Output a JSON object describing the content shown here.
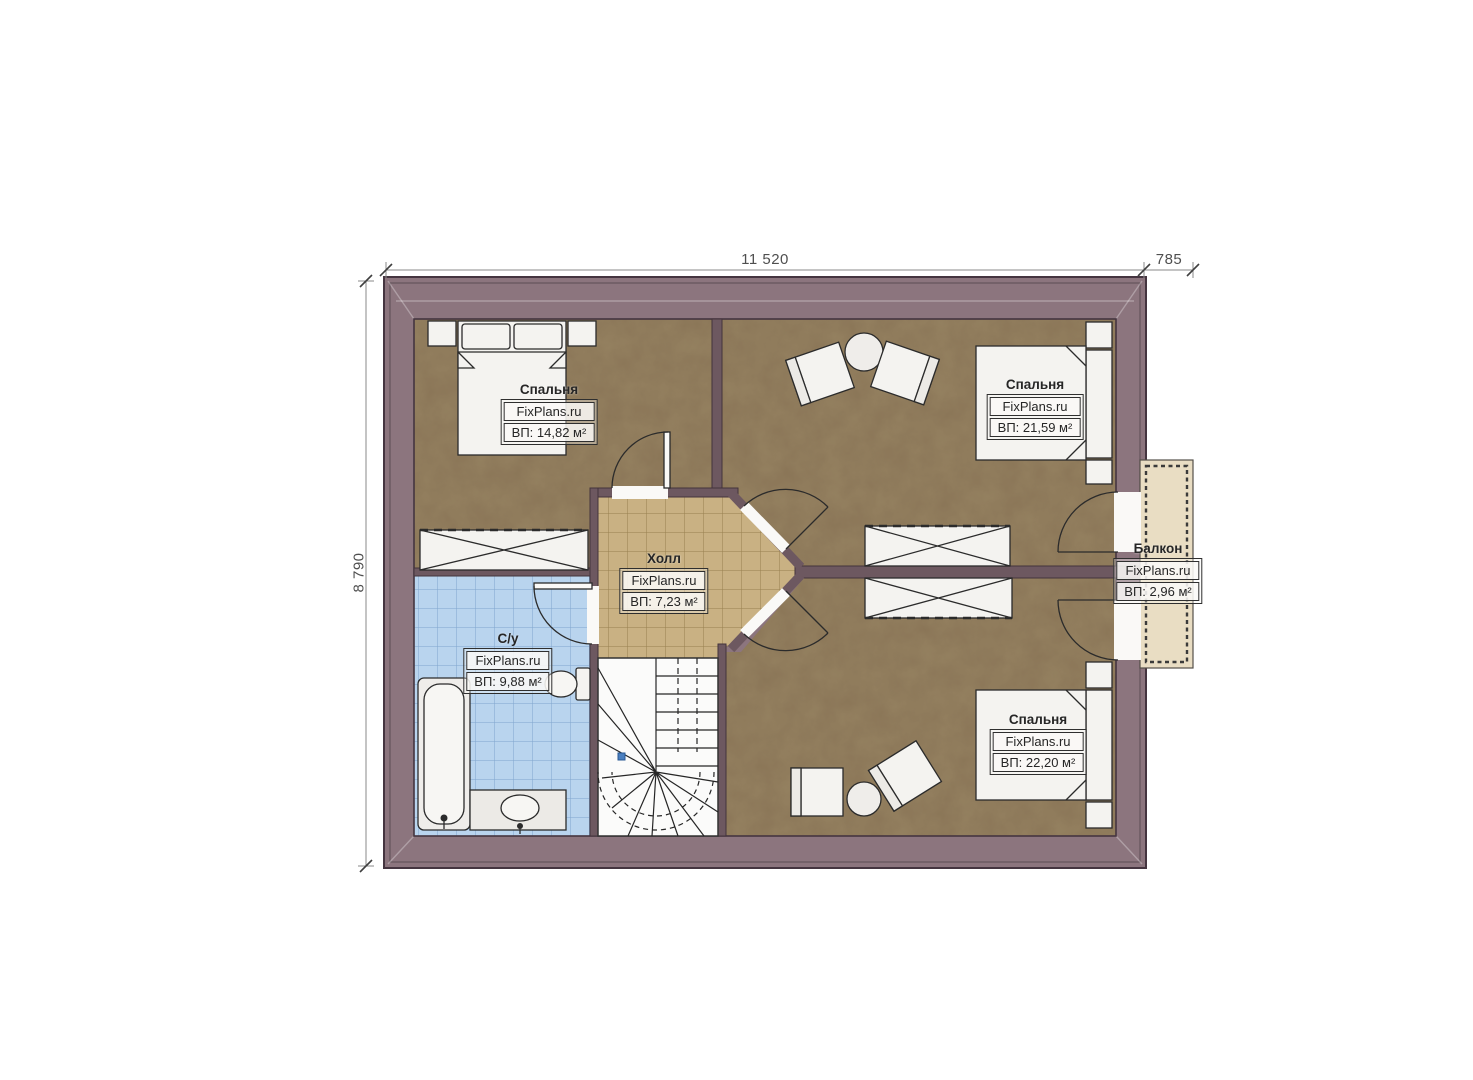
{
  "dimensions": {
    "width_main": "11 520",
    "width_balcony": "785",
    "height_left": "8 790"
  },
  "watermark": "FixPlans.ru",
  "rooms": {
    "bedroom_top_left": {
      "name": "Спальня",
      "brand": "FixPlans.ru",
      "area": "ВП: 14,82 м²"
    },
    "bedroom_top_right": {
      "name": "Спальня",
      "brand": "FixPlans.ru",
      "area": "ВП: 21,59 м²"
    },
    "hall": {
      "name": "Холл",
      "brand": "FixPlans.ru",
      "area": "ВП: 7,23 м²"
    },
    "bathroom": {
      "name": "С/у",
      "brand": "FixPlans.ru",
      "area": "ВП: 9,88 м²"
    },
    "balcony": {
      "name": "Балкон",
      "brand": "FixPlans.ru",
      "area": "ВП: 2,96 м²"
    },
    "bedroom_bottom_right": {
      "name": "Спальня",
      "brand": "FixPlans.ru",
      "area": "ВП: 22,20 м²"
    }
  },
  "colors": {
    "outer_wall": "#8C757E",
    "inner_wall": "#6D5860",
    "floor_brown": "#8A7557",
    "floor_hall": "#C9B183",
    "floor_bathroom": "#B9D4EE",
    "floor_balcony": "#E9DDC3",
    "outline": "#2B2B2B",
    "dimension_text": "#4F4F4F",
    "stair_marker": "#4A7FC0"
  }
}
